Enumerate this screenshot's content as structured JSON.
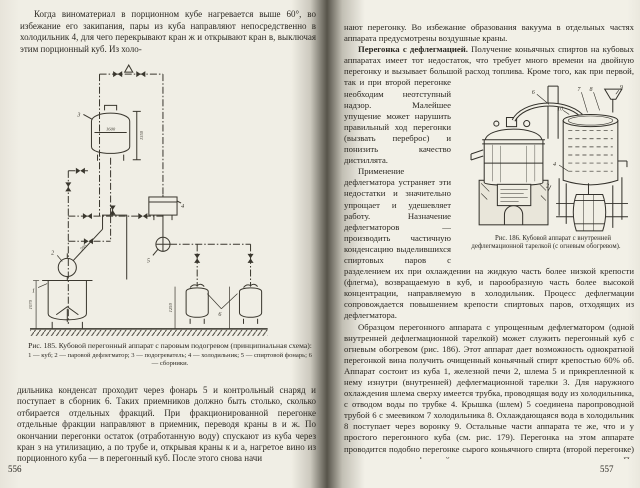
{
  "colors": {
    "paper": "#f1efe6",
    "ink": "#2b2822",
    "gutter": "#57544a"
  },
  "doc": {
    "left_page": {
      "page_number": "556",
      "para_top": "Когда виноматериал в порционном кубе нагревается выше 60°, во избежание его закипания, пары из куба направляют непосредственно в холодильник 4, для чего перекрывают кран ж и открывают кран в, выключая этим порционный куб. Из холо-",
      "para_bottom": "дильника конденсат проходит через фонарь 5 и контрольный снаряд и поступает в сборник 6. Таких приемников должно быть столько, сколько отбирается отдельных фракций. При фракционированной перегонке отдельные фракции направляют в приемник, переводя краны в и ж. По окончании перегонки остаток (отработанную воду) спускают из куба через кран з на утилизацию, а по трубе и, открывая краны к и а, нагретое вино из порционного куба — в перегонный куб. После этого снова начи",
      "fig185": {
        "caption_title": "Рис. 185. Кубовой перегонный аппарат с паровым подогревом (принципиальная схема):",
        "caption_legend": "1 — куб; 2 — паровой дефлегматор; 3 — подогреватель; 4 — холодильник; 5 — спиртовой фонарь; 6 — сборники.",
        "labels": {
          "l1": "1",
          "l2": "2",
          "l3": "3",
          "l4": "4",
          "l5": "5",
          "l6": "6",
          "dim_kettle": "1600",
          "dim_height": "1350",
          "dim_cube": "1070",
          "dim_collector": "1250",
          "pipe_note": "595"
        }
      }
    },
    "right_page": {
      "page_number": "557",
      "para_1": "нают перегонку. Во избежание образования вакуума в отдельных частях аппарата предусмотрены воздушные краны.",
      "para_2_lead": "Перегонка с дефлегмацией.",
      "para_2_text": " Получение коньячных спиртов на кубовых аппаратах имеет тот недостаток, что требует много времени на двойную перегонку и вызывает большой расход топлива. Кроме того, как при первой, так и при второй перегонке необходим неотступный надзор. Малейшее упущение может нарушить правильный ход перегонки (вызвать переброс) и понизить качество дистиллята.",
      "para_3": "Применение дефлегматора устраняет эти недостатки и значительно упрощает и удешевляет работу. Назначение дефлегматоров — производить частичную конденсацию выделившихся спиртовых паров с разделением их при охлаждении на жидкую часть более низкой крепости (флегма), возвращаемую в куб, и парообразную часть более высокой концентрации, направляемую в холодильник. Процесс дефлегмации сопровождается повышением крепости спиртовых паров, отходящих из дефлегматора.",
      "para_4": "Образцом перегонного аппарата с упрощенным дефлегматором (одной внутренней дефлегмационной тарелкой) может служить перегонный куб с огневым обогревом (рис. 186). Этот аппарат дает возможность однократной перегонкой вина получить очищенный коньячный спирт крепостью 60% об. Аппарат состоит из куба 1, железной печи 2, шлема 5 и прикрепленной к нему изнутри (внутренней) дефлегмационной тарелки 3. Для наружного охлаждения шлема сверху имеется трубка, проводящая воду из холодильника, с отводом воды по трубке 4. Крышка (шлем) 5 соединена паропроводной трубой 6 с змеевиком 7 холодильника 8. Охлаждающаяся вода в холодильник 8 поступает через воронку 9. Остальные части аппарата те же, что и у простого перегонного куба (см. рис. 179). Перегонка на этом аппарате проводится подобно перегонке сырого коньячного спирта (второй перегонке) с отделением трех фракций: головного, среднего и хвостового погонов. По наполнении куба на 4/5 его емкости вином, при открытом кране 10, под кубом разводят огонь и",
      "fig186": {
        "caption": "Рис. 186. Кубовой аппарат с внутренней дефлегмационной тарелкой (с огневым обогревом).",
        "labels": {
          "l2": "2",
          "l4": "4",
          "l6": "6",
          "l7": "7",
          "l8": "8",
          "l9": "9",
          "l10": "10"
        }
      }
    }
  }
}
